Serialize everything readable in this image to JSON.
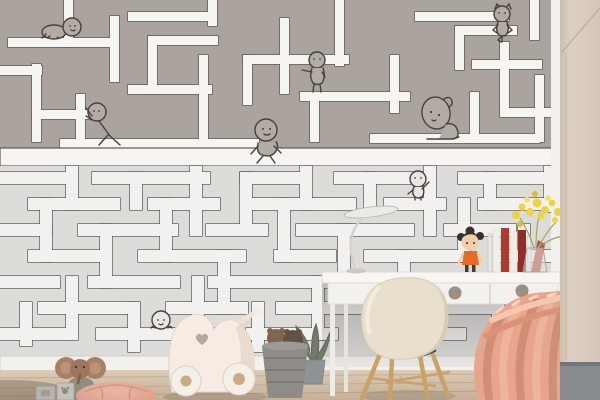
{
  "scene": {
    "description": "Children's room photo: maze wallpaper mural with doodle characters, white desk, cream shell chair, toy pram, plush toys and coral knit blanket",
    "wall": {
      "upper_maze": {
        "label": "upper maze mural band",
        "background": "#a8a19b",
        "path_color": "#f6f5f2",
        "line_color": "#57524d"
      },
      "lower_maze": {
        "label": "lower maze mural band",
        "background": "#dcdbd8",
        "path_color": "#f2f1ef",
        "line_color": "#4c4b47"
      },
      "side_wall": {
        "label": "beige side wall",
        "color": "#d7cabb"
      },
      "baseboard": {
        "label": "white baseboard",
        "color": "#f3f1ee"
      }
    },
    "floor": {
      "label": "light wood floor",
      "color": "#cdbba4"
    },
    "characters": {
      "crawler": {
        "label": "crawling baby doodle"
      },
      "pusher": {
        "label": "doodle pushing a maze wall"
      },
      "walker": {
        "label": "walking doodle"
      },
      "pointer": {
        "label": "pointing doodle"
      },
      "cat_yogi": {
        "label": "cat-ear doodle in yoga pose"
      },
      "thinker": {
        "label": "big head-scratching doodle"
      },
      "waver": {
        "label": "waving doodle"
      },
      "peeker": {
        "label": "doodle peeking over maze wall"
      }
    },
    "objects": {
      "desk": {
        "label": "white desk with drawers",
        "knob_color": "#a9876b"
      },
      "lamp": {
        "label": "white desk lamp"
      },
      "doll": {
        "label": "doll with black pigtails and orange dress"
      },
      "books": {
        "label": "books between clear bookends",
        "colors": [
          "#f2efe9",
          "#a83228",
          "#8c251e",
          "#b5453a"
        ]
      },
      "vase": {
        "label": "glass vase with yellow mimosa flowers",
        "flower_color": "#ecd23e"
      },
      "chair": {
        "label": "cream shell chair with wooden legs",
        "seat_color": "#e9deca",
        "leg_color": "#c79f63"
      },
      "blanket": {
        "label": "coral chunky knit blanket",
        "color": "#e5a288"
      },
      "bench": {
        "label": "window seat with gray cushion",
        "cushion_color": "#9a9894"
      },
      "cabinet": {
        "label": "beige wardrobe panel",
        "color": "#d7cabb"
      },
      "pram": {
        "label": "white wooden toy pram with heart cutout"
      },
      "basket": {
        "label": "gray basket with plush bears"
      },
      "pouf": {
        "label": "blush floor pouf",
        "color": "#e0a28e"
      },
      "elephant": {
        "label": "plush elephant toy"
      },
      "blocks": {
        "label": "small wooden toy blocks"
      },
      "plant": {
        "label": "potted plant behind chair"
      }
    }
  }
}
